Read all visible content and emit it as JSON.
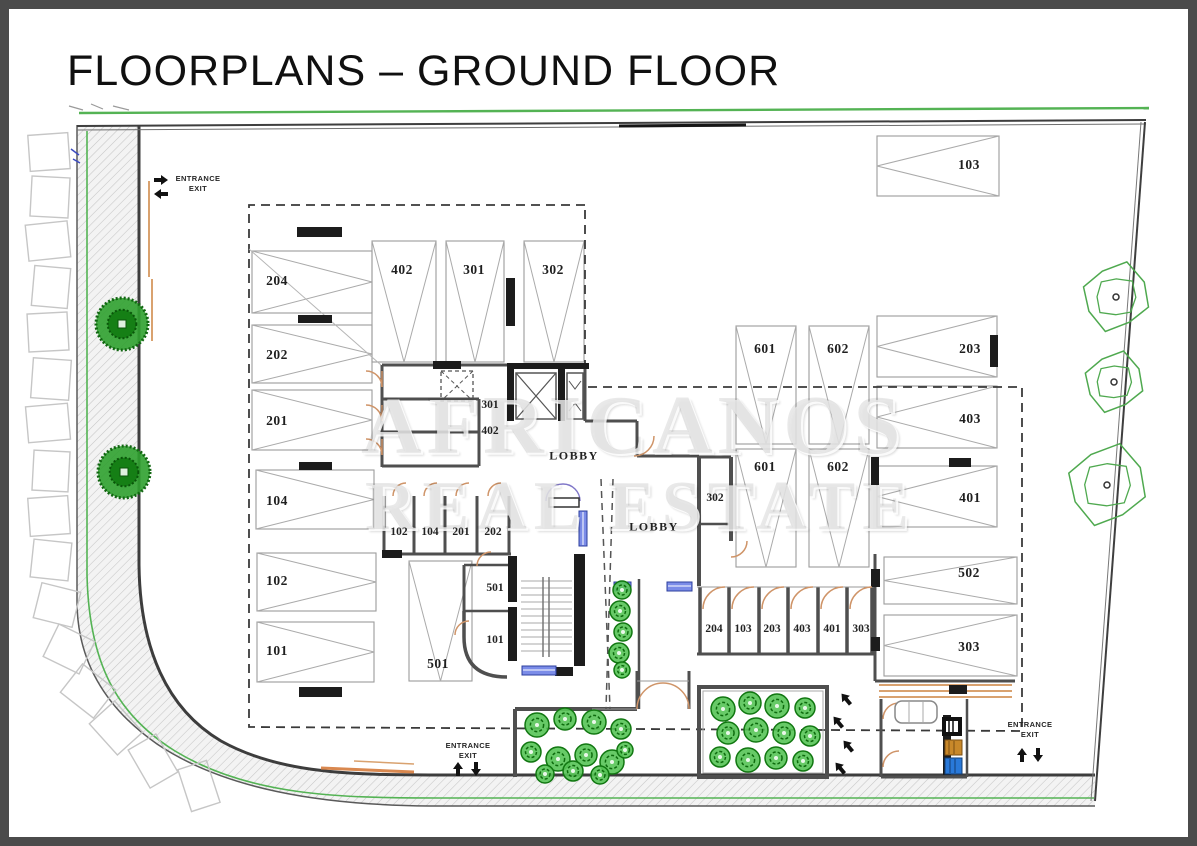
{
  "page": {
    "title": "FLOORPLANS – GROUND FLOOR"
  },
  "watermark": {
    "line1": "AFRICANOS",
    "line2": "REAL ESTATE"
  },
  "entrance_markers": {
    "top_left": {
      "entrance": "ENTRANCE",
      "exit": "EXIT"
    },
    "bottom_center": {
      "entrance": "ENTRANCE",
      "exit": "EXIT"
    },
    "bottom_right": {
      "entrance": "ENTRANCE",
      "exit": "EXIT"
    }
  },
  "lobbies": {
    "upper": "LOBBY",
    "lower": "LOBBY"
  },
  "colors": {
    "boundary_green": "#54b354",
    "tree_green": "#2fa12f",
    "door_tan": "#cf9468",
    "window_blue": "#7b8ce8",
    "wall_gray": "#4f4f4f",
    "bin_orange": "#c8882a",
    "bin_blue": "#2979d9"
  },
  "parking_spaces": [
    {
      "id": "p204",
      "label": "204"
    },
    {
      "id": "p202",
      "label": "202"
    },
    {
      "id": "p201",
      "label": "201"
    },
    {
      "id": "p104",
      "label": "104"
    },
    {
      "id": "p102",
      "label": "102"
    },
    {
      "id": "p101",
      "label": "101"
    },
    {
      "id": "t402",
      "label": "402"
    },
    {
      "id": "t301",
      "label": "301"
    },
    {
      "id": "t302",
      "label": "302"
    },
    {
      "id": "u601",
      "label": "601"
    },
    {
      "id": "u602",
      "label": "602"
    },
    {
      "id": "l601",
      "label": "601"
    },
    {
      "id": "l602",
      "label": "602"
    },
    {
      "id": "b501",
      "label": "501"
    },
    {
      "id": "r103",
      "label": "103"
    },
    {
      "id": "r203",
      "label": "203"
    },
    {
      "id": "r403",
      "label": "403"
    },
    {
      "id": "r401",
      "label": "401"
    },
    {
      "id": "r502",
      "label": "502"
    },
    {
      "id": "r303",
      "label": "303"
    }
  ],
  "storage_rooms": [
    {
      "id": "st301",
      "label": "301"
    },
    {
      "id": "st402",
      "label": "402"
    },
    {
      "id": "rm102",
      "label": "102"
    },
    {
      "id": "rm104",
      "label": "104"
    },
    {
      "id": "rm201",
      "label": "201"
    },
    {
      "id": "rm202",
      "label": "202"
    },
    {
      "id": "st501",
      "label": "501"
    },
    {
      "id": "st101",
      "label": "101"
    },
    {
      "id": "st302",
      "label": "302"
    },
    {
      "id": "rw204",
      "label": "204"
    },
    {
      "id": "rw103",
      "label": "103"
    },
    {
      "id": "rw203",
      "label": "203"
    },
    {
      "id": "rw403",
      "label": "403"
    },
    {
      "id": "rw401",
      "label": "401"
    },
    {
      "id": "rw303",
      "label": "303"
    }
  ]
}
